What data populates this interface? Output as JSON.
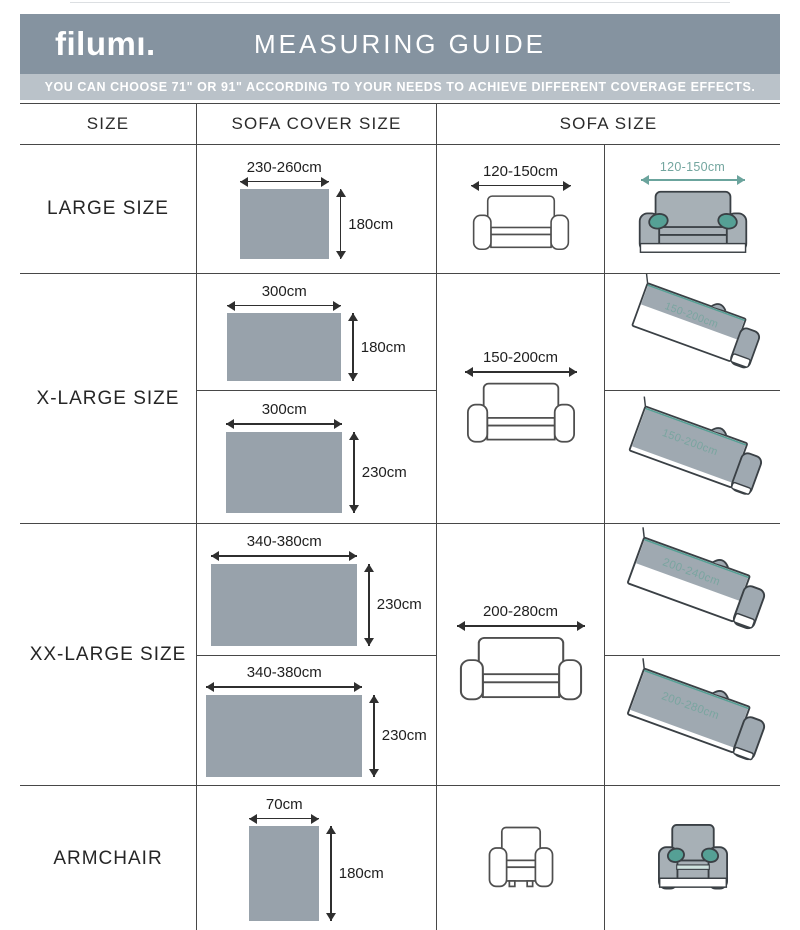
{
  "header": {
    "logo": "filumı.",
    "title": "MEASURING GUIDE"
  },
  "banner": {
    "text": "YOU CAN CHOOSE 71\" OR 91\" ACCORDING TO YOUR NEEDS TO ACHIEVE DIFFERENT COVERAGE EFFECTS."
  },
  "columns": {
    "size": "SIZE",
    "cover": "SOFA COVER SIZE",
    "sofa": "SOFA SIZE"
  },
  "colors": {
    "header_bg": "#8593a0",
    "banner_bg": "#bac2c9",
    "rect_fill": "#98a2ab",
    "sofa_fill": "#a7b0b6",
    "accent_teal": "#55a095",
    "teal_label": "#73a69f",
    "grid_line": "#474747",
    "text": "#262626"
  },
  "rows": {
    "large": {
      "label": "LARGE SIZE",
      "cover": {
        "width": "230-260cm",
        "height": "180cm"
      },
      "sofa": "120-150cm",
      "covered": "120-150cm"
    },
    "xlarge": {
      "label": "X-LARGE SIZE",
      "covers": [
        {
          "width": "300cm",
          "height": "180cm"
        },
        {
          "width": "300cm",
          "height": "230cm"
        }
      ],
      "sofa": "150-200cm",
      "covered": [
        "150-200cm",
        "150-200cm"
      ]
    },
    "xxlarge": {
      "label": "XX-LARGE SIZE",
      "covers": [
        {
          "width": "340-380cm",
          "height": "230cm"
        },
        {
          "width": "340-380cm",
          "height": "230cm"
        }
      ],
      "sofa": "200-280cm",
      "covered": [
        "200-240cm",
        "200-280cm"
      ]
    },
    "armchair": {
      "label": "ARMCHAIR",
      "cover": {
        "width": "70cm",
        "height": "180cm"
      }
    }
  }
}
